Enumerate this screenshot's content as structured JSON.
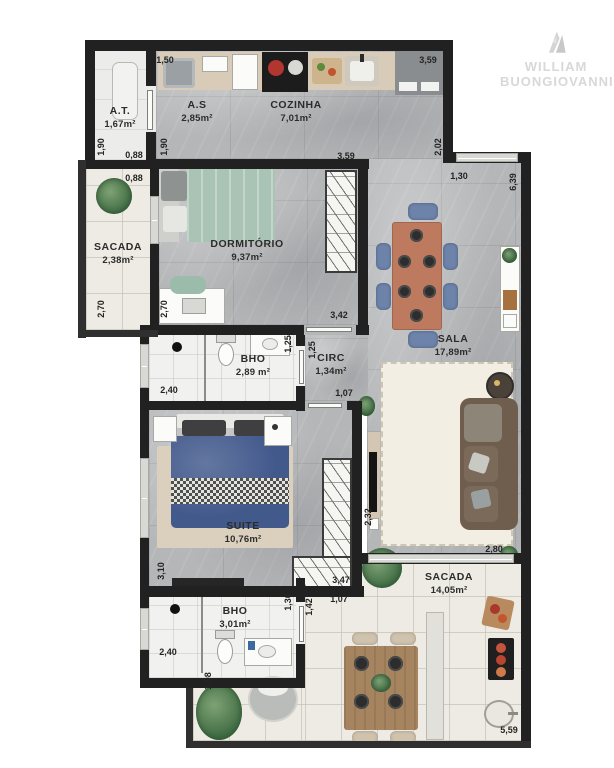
{
  "watermark": {
    "line1": "WILLIAM",
    "line2": "BUONGIOVANNI"
  },
  "palette": {
    "wall": "#212121",
    "floor_main": "#b5b6b8",
    "floor_balcony": "#edebe3",
    "bed_suite_blue": "#42598c",
    "bed_dorm_green": "#a9c3b4",
    "dining_chair_blue": "#6d83aa",
    "table_terracotta": "#bd7a5e",
    "sofa_brown": "#6f5d4d",
    "outdoor_wood": "#a5845f"
  },
  "rooms": [
    {
      "name": "A.T.",
      "area": "1,67m²"
    },
    {
      "name": "A.S",
      "area": "2,85m²"
    },
    {
      "name": "COZINHA",
      "area": "7,01m²"
    },
    {
      "name": "SACADA",
      "area": "2,38m²"
    },
    {
      "name": "DORMITÓRIO",
      "area": "9,37m²"
    },
    {
      "name": "SALA",
      "area": "17,89m²"
    },
    {
      "name": "BHO",
      "area": "2,89 m²"
    },
    {
      "name": "CIRC",
      "area": "1,34m²"
    },
    {
      "name": "SUITE",
      "area": "10,76m²"
    },
    {
      "name": "BHO",
      "area": "3,01m²"
    },
    {
      "name": "SACADA",
      "area": "14,05m²"
    }
  ],
  "dimensions": [
    "1,50",
    "3,59",
    "1,90",
    "0,88",
    "1,90",
    "0,88",
    "3,59",
    "2,02",
    "1,30",
    "6,39",
    "2,70",
    "2,70",
    "3,42",
    "1,25",
    "1,25",
    "2,40",
    "1,07",
    "3,10",
    "2,32",
    "3,47",
    "1,07",
    "1,30",
    "1,42",
    "2,40",
    "1,08",
    "2,80",
    "5,59"
  ]
}
